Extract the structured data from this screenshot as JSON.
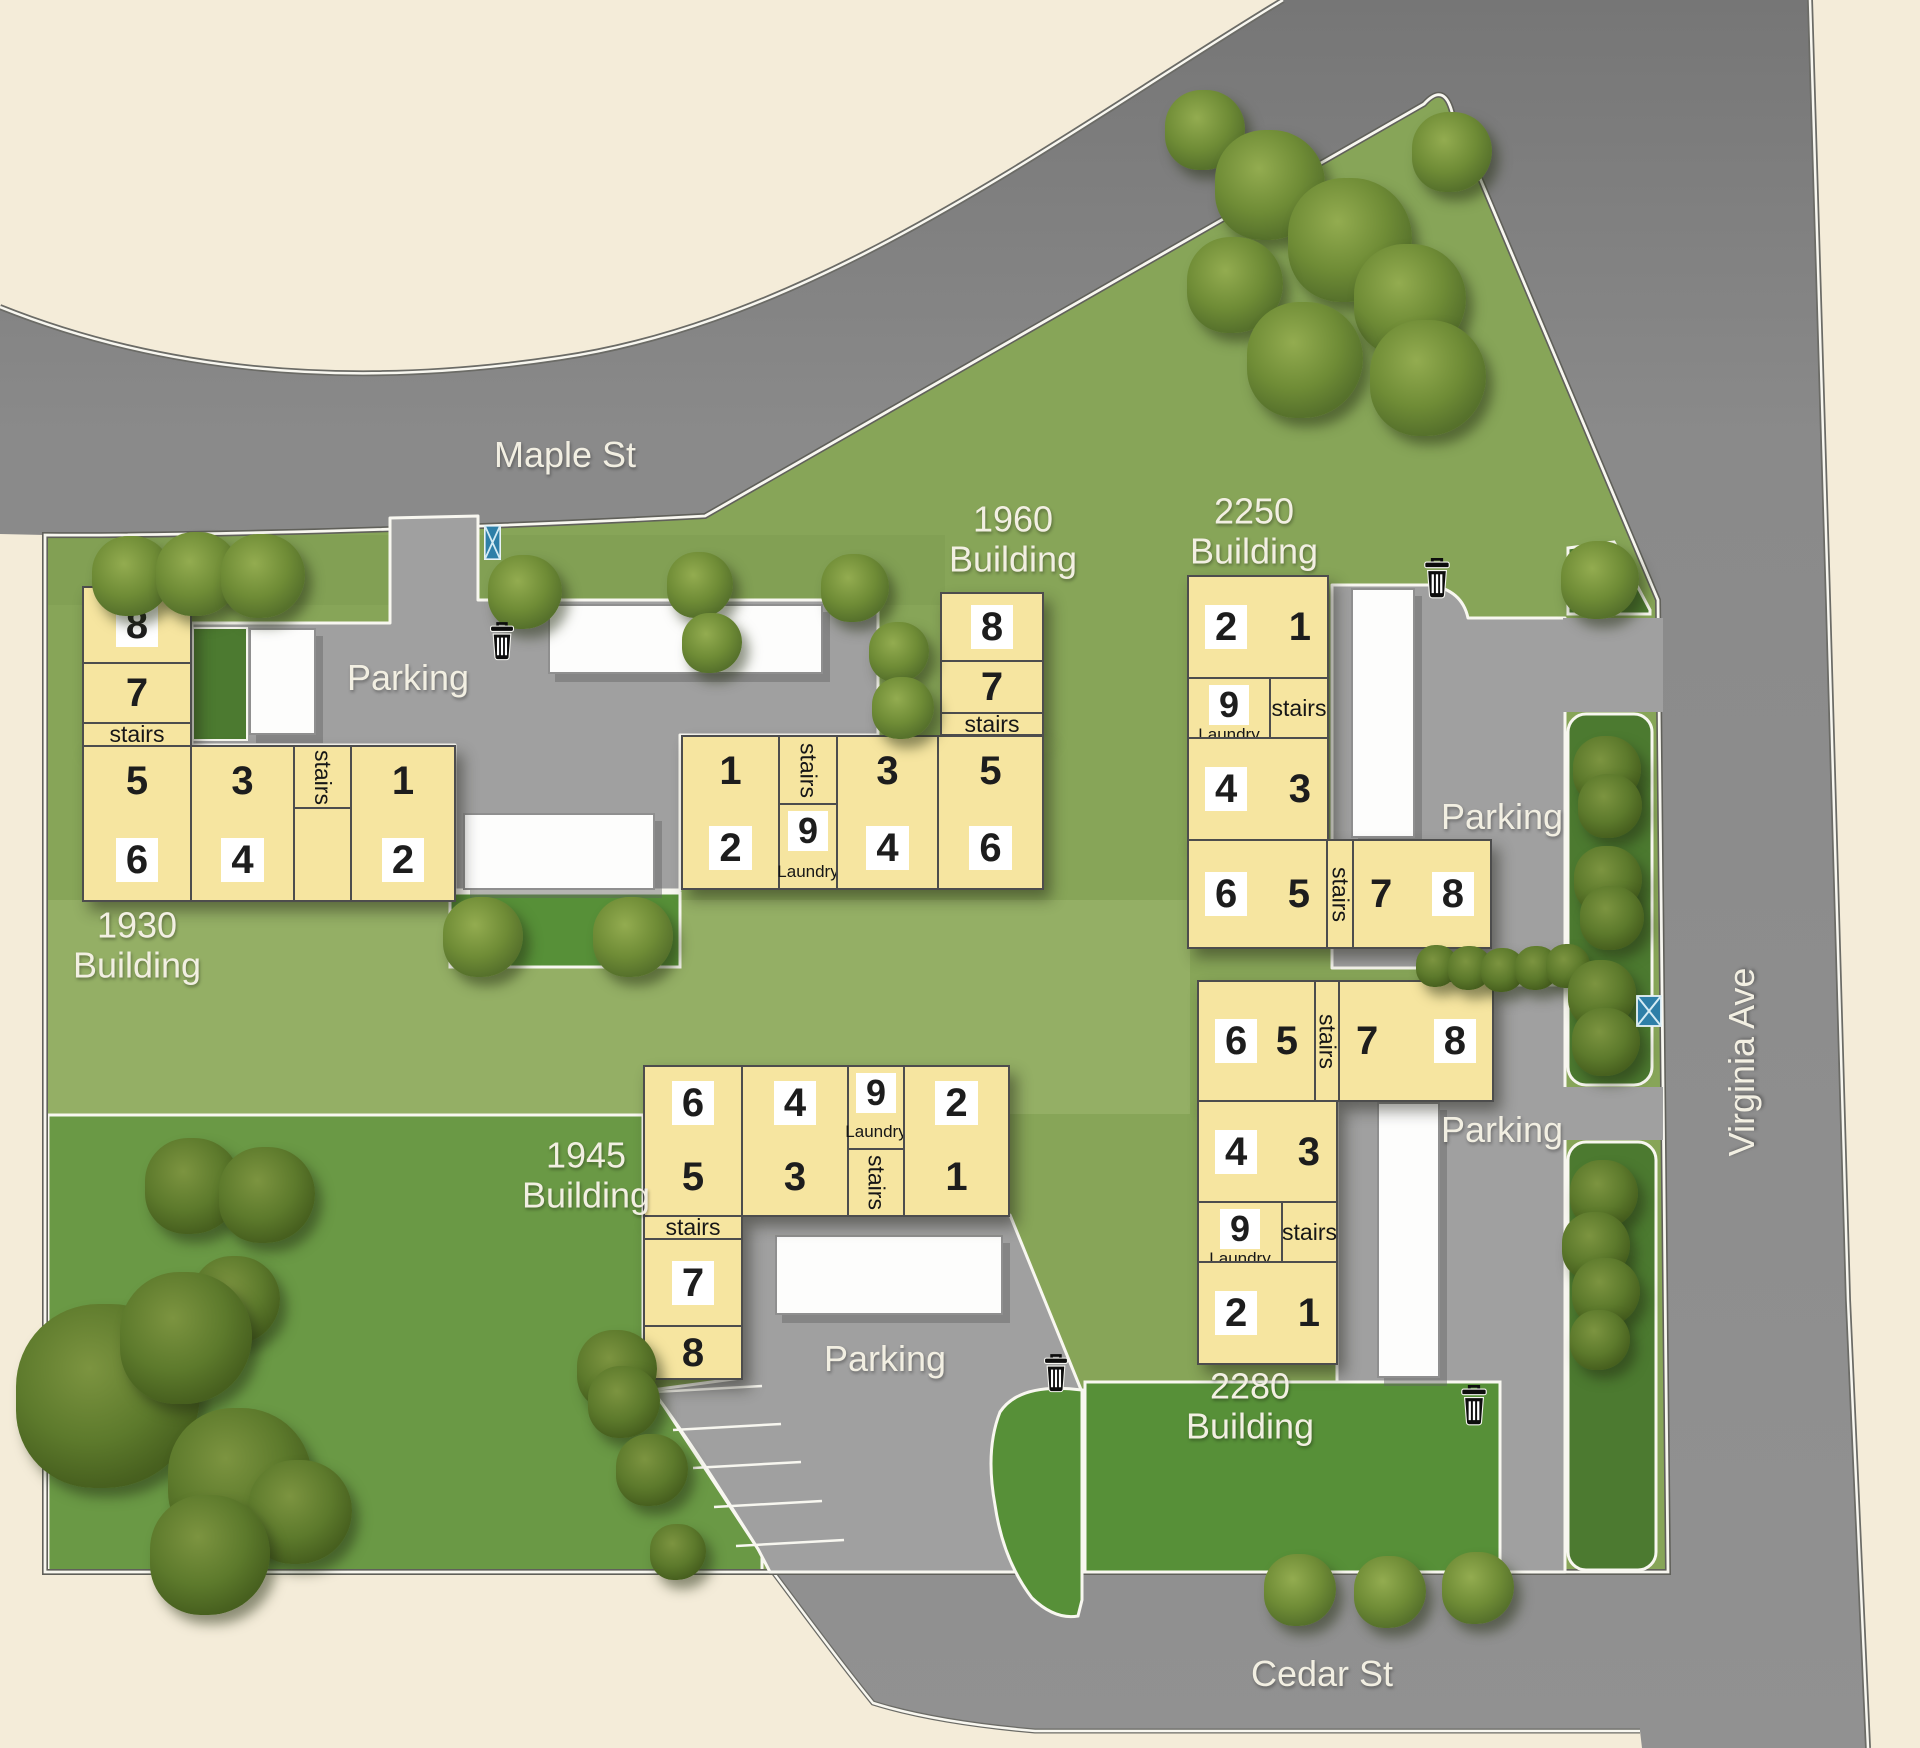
{
  "site_map": {
    "streets": {
      "maple": "Maple St",
      "virginia": "Virginia Ave",
      "cedar": "Cedar St"
    },
    "labels": {
      "parking": "Parking",
      "stairs": "stairs",
      "laundry": "Laundry"
    },
    "buildings": {
      "b1930": {
        "title": "1930",
        "subtitle": "Building",
        "units": {
          "1": "1",
          "2": "2",
          "3": "3",
          "4": "4",
          "5": "5",
          "6": "6",
          "7": "7",
          "8": "8"
        }
      },
      "b1960": {
        "title": "1960",
        "subtitle": "Building",
        "units": {
          "1": "1",
          "2": "2",
          "3": "3",
          "4": "4",
          "5": "5",
          "6": "6",
          "7": "7",
          "8": "8",
          "9": "9"
        }
      },
      "b2250": {
        "title": "2250",
        "subtitle": "Building",
        "units": {
          "1": "1",
          "2": "2",
          "3": "3",
          "4": "4",
          "5": "5",
          "6": "6",
          "7": "7",
          "8": "8",
          "9": "9"
        }
      },
      "b2280": {
        "title": "2280",
        "subtitle": "Building",
        "units": {
          "1": "1",
          "2": "2",
          "3": "3",
          "4": "4",
          "5": "5",
          "6": "6",
          "7": "7",
          "8": "8",
          "9": "9"
        }
      },
      "b1945": {
        "title": "1945",
        "subtitle": "Building",
        "units": {
          "1": "1",
          "2": "2",
          "3": "3",
          "4": "4",
          "5": "5",
          "6": "6",
          "7": "7",
          "8": "8",
          "9": "9"
        }
      }
    },
    "colors": {
      "background": "#f4ecd9",
      "road": "#8a8a8a",
      "parking_lot": "#a0a0a0",
      "grass": "#87a558",
      "lawn": "#6a9945",
      "yard_green": "#579038",
      "hedge_green": "#4c7a30",
      "building": "#f6e5a0",
      "building_border": "#4d4d4d",
      "curb": "#f8f7f0",
      "label_text": "#f2efe2",
      "unit_text": "#1d1d1d",
      "mailbox_blue": "#2e7fa8",
      "trash_black": "#0d0d0d"
    }
  }
}
